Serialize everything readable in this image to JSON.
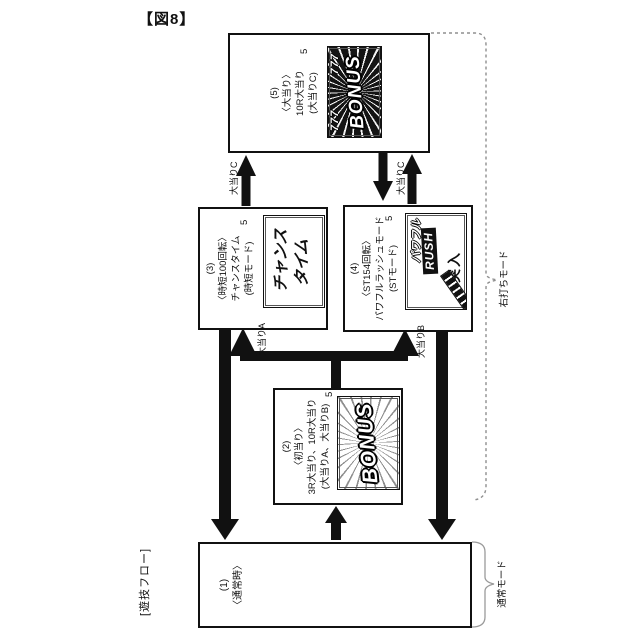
{
  "title": "【図8】",
  "flow_label": "[遊技フロー]",
  "brackets": {
    "right_strike_label": "右打ちモード",
    "normal_label": "通常モード"
  },
  "box1": {
    "num": "(1)",
    "name": "〈通常時〉"
  },
  "box2": {
    "num": "(2)",
    "name": "〈初当り〉",
    "detail1": "3R大当り、10R大当り",
    "detail2": "(大当りA、大当りB)",
    "screen_ref": "5",
    "screen_text": "BONUS"
  },
  "box3": {
    "num": "(3)",
    "name": "〈時短100回転〉",
    "detail1": "チャンスタイム",
    "detail2": "(時短モード)",
    "screen_ref": "5",
    "screen_line1": "チャンス",
    "screen_line2": "タイム"
  },
  "box4": {
    "num": "(4)",
    "name": "〈ST154回転〉",
    "detail1": "パワフルラッシュモード",
    "detail2": "(STモード)",
    "screen_ref": "5",
    "screen_word1": "パワフル",
    "screen_word2": "RUSH",
    "screen_word3": "突入"
  },
  "box5": {
    "num": "(5)",
    "name": "〈大当り〉",
    "detail1": "10R大当り",
    "detail2": "(大当りC)",
    "screen_ref": "5",
    "screen_sevens_left": "777",
    "screen_sevens_right": "777",
    "screen_text": "BONUS"
  },
  "arrows": {
    "jackpot_a": "大当りA",
    "jackpot_b": "大当りB",
    "jackpot_c_left": "大当りC",
    "jackpot_c_right": "大当りC"
  },
  "colors": {
    "line": "#111111",
    "background": "#ffffff",
    "bracket_gray": "#8f8f8f",
    "screen_dark": "#141414"
  }
}
